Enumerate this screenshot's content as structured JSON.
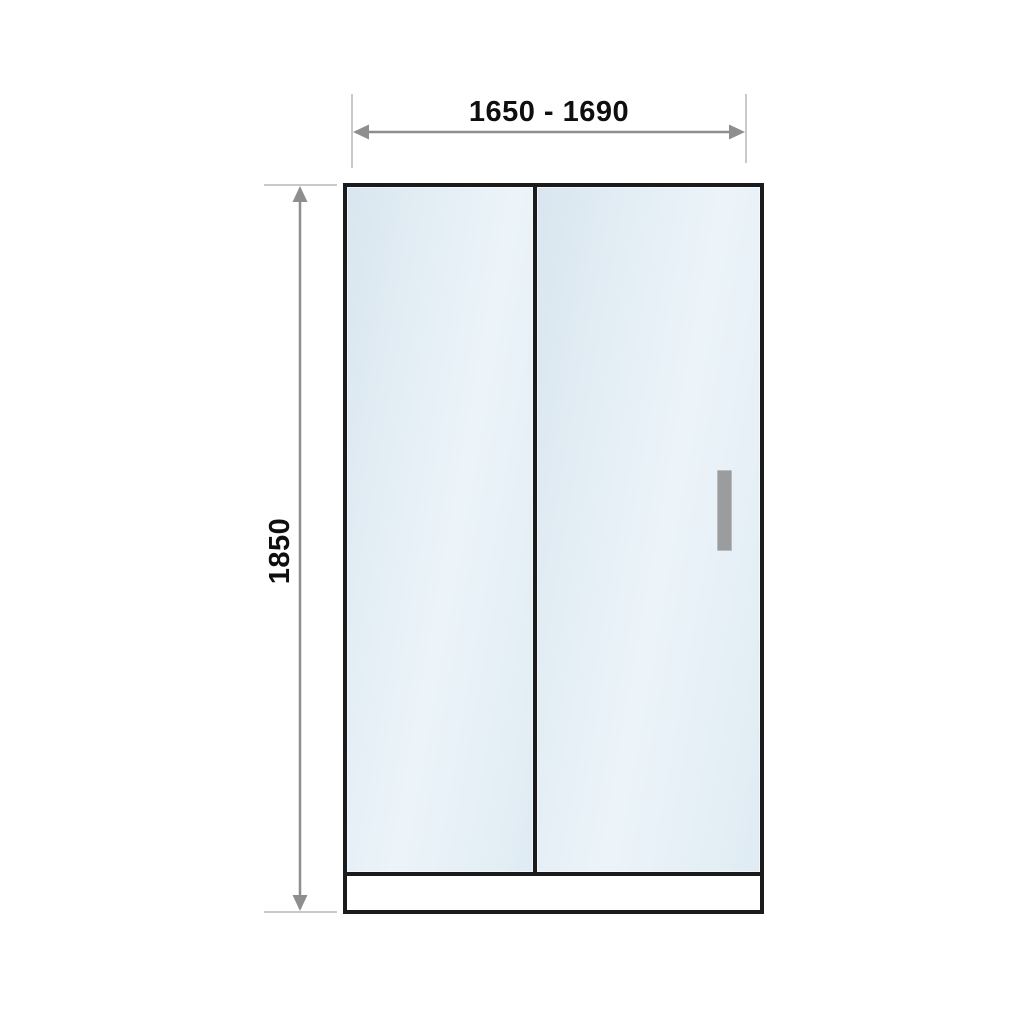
{
  "diagram": {
    "type": "product-dimension-diagram",
    "subject": "sliding-shower-door-front-view",
    "width_dimension": {
      "label": "1650 - 1690"
    },
    "height_dimension": {
      "label": "1850"
    },
    "colors": {
      "background": "#ffffff",
      "frame": "#1b1b1b",
      "glass_light": "#ecf4f9",
      "glass_dark": "#d9e6ef",
      "handle": "#9a9c9e",
      "tray": "#ffffff",
      "dimension_arrow": "#8e8e8e",
      "extension_line": "#c9c9c9",
      "label_text": "#0f0f0f"
    }
  }
}
